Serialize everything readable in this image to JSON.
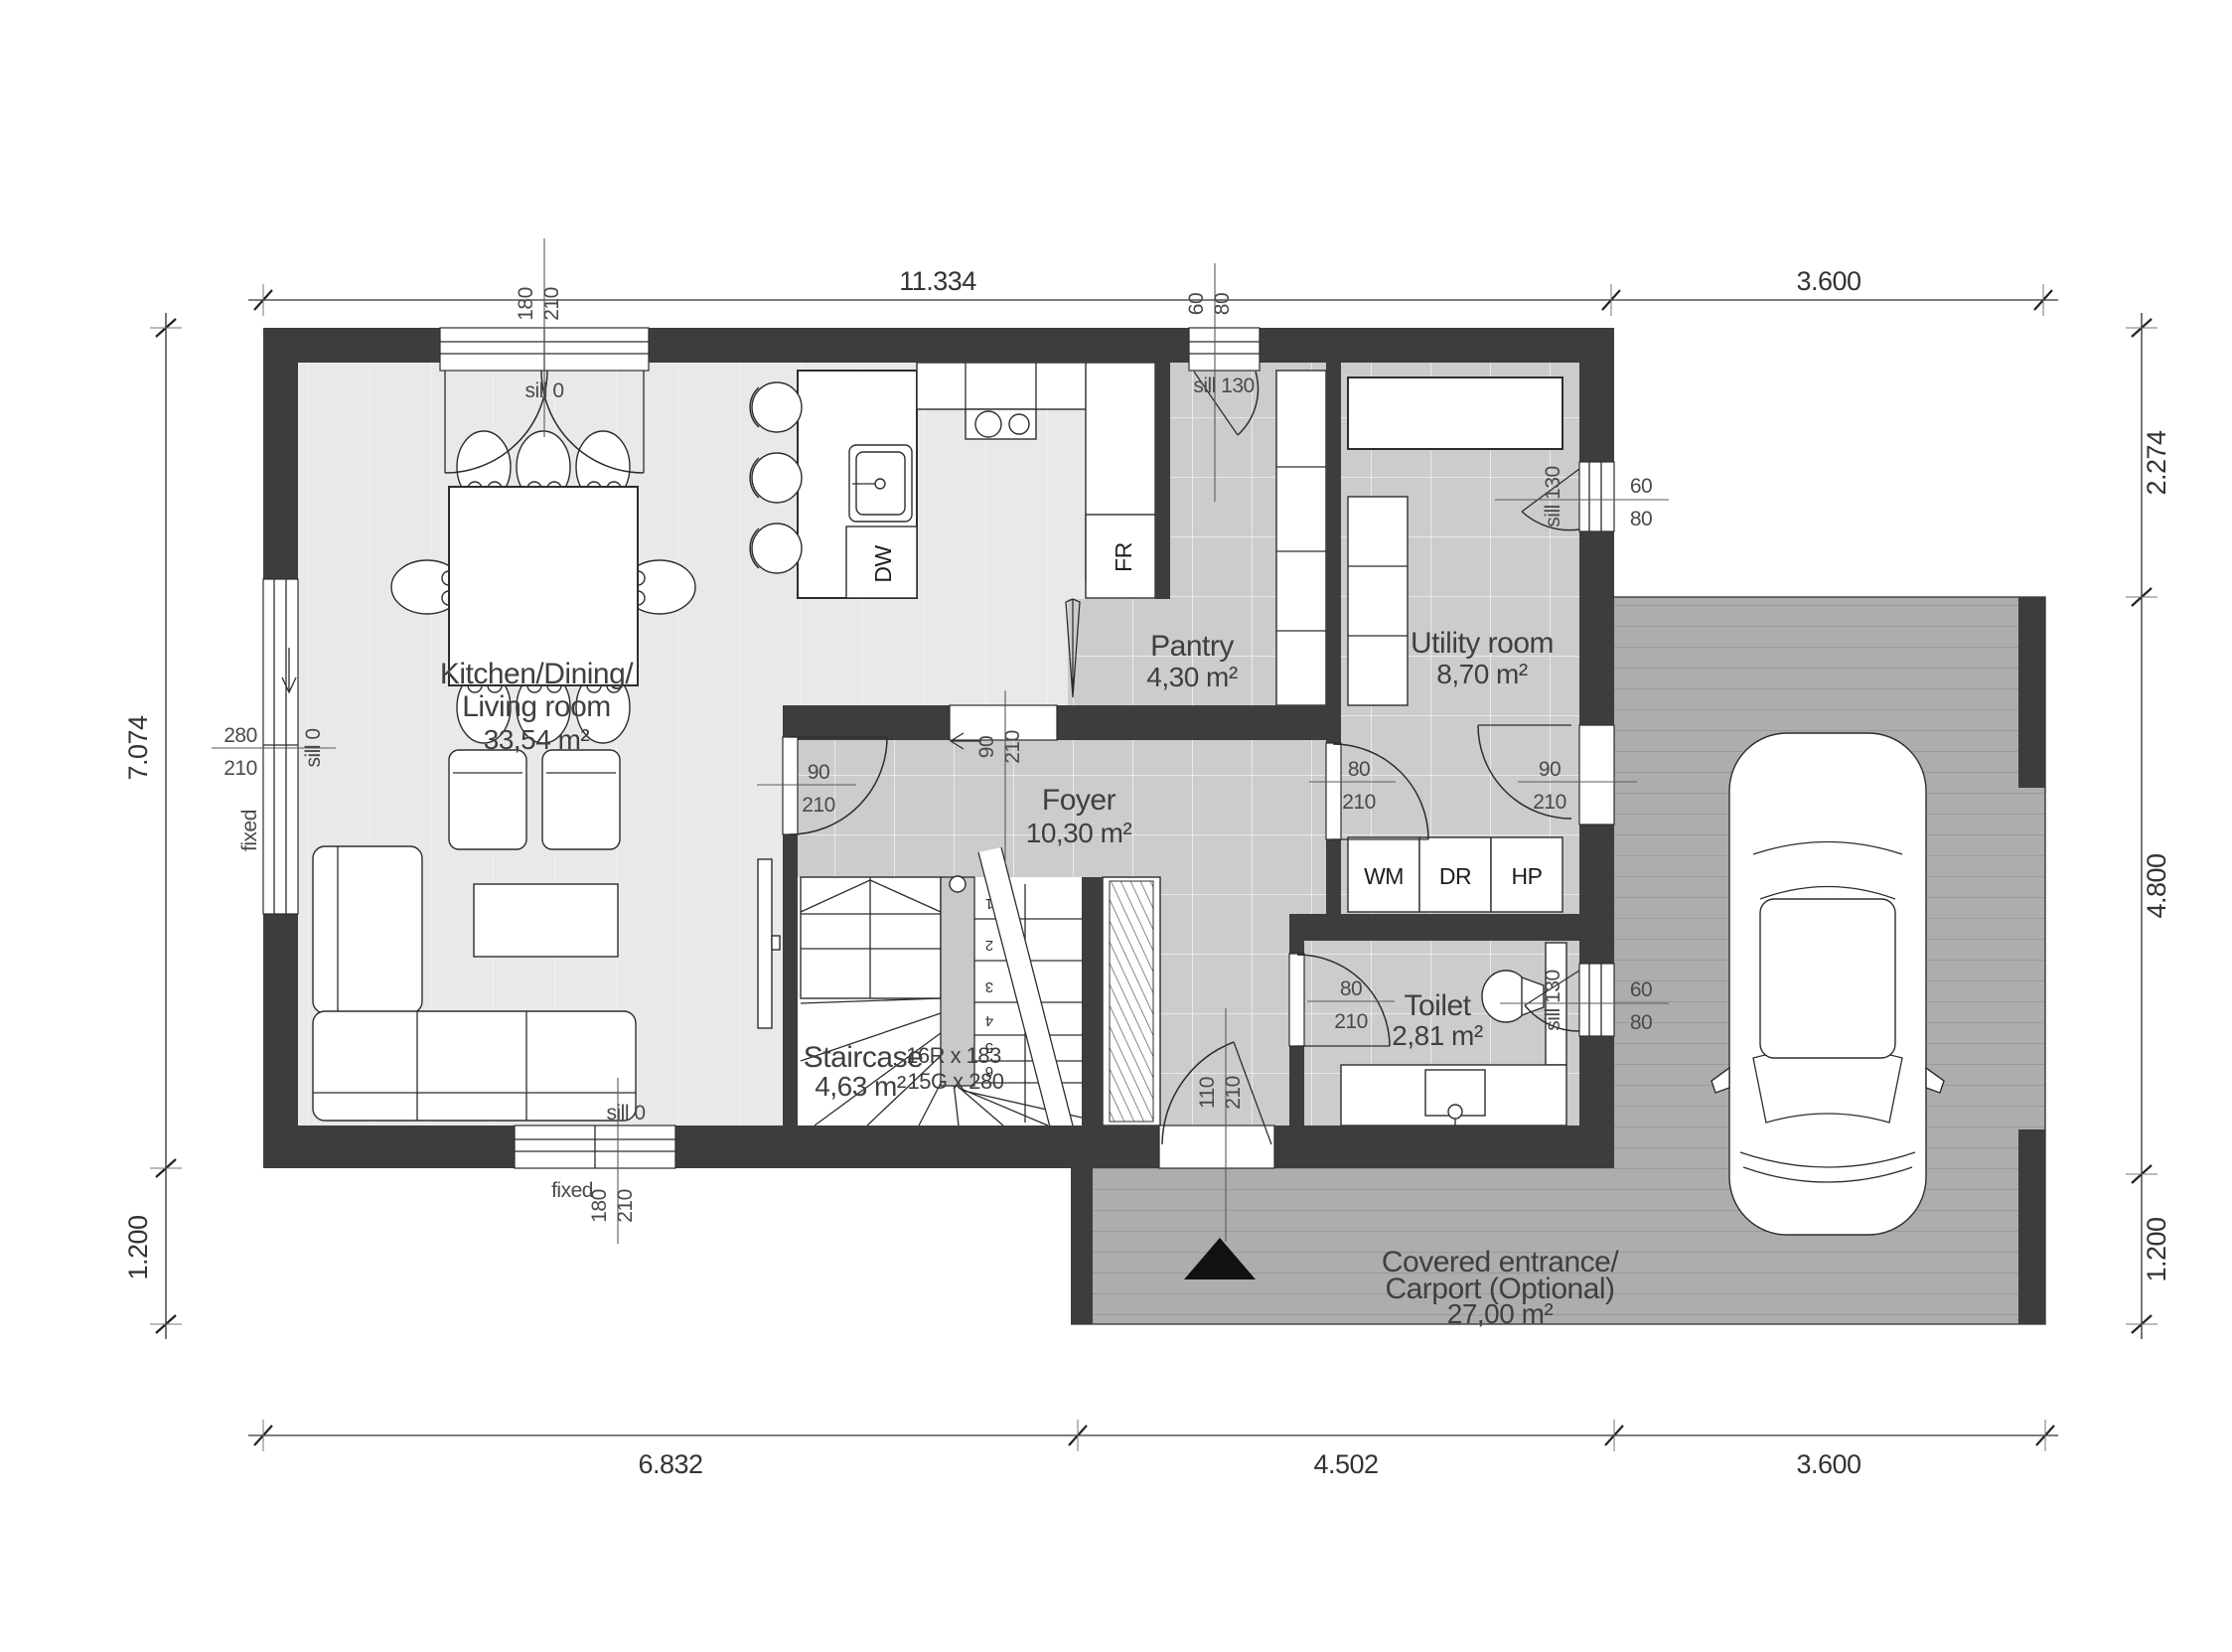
{
  "rooms": {
    "living": {
      "line1": "Kitchen/Dining/",
      "line2": "Living room",
      "area": "33,54 m²"
    },
    "pantry": {
      "name": "Pantry",
      "area": "4,30 m²"
    },
    "utility": {
      "name": "Utility room",
      "area": "8,70 m²"
    },
    "foyer": {
      "name": "Foyer",
      "area": "10,30 m²"
    },
    "staircase": {
      "name": "Staircase",
      "area": "4,63 m²",
      "risers": "16R x 183",
      "goings": "15G x 280"
    },
    "toilet": {
      "name": "Toilet",
      "area": "2,81 m²"
    },
    "carport": {
      "line1": "Covered entrance/",
      "line2": "Carport (Optional)",
      "area": "27,00 m²"
    }
  },
  "appliances": {
    "dw": "DW",
    "fr": "FR",
    "wm": "WM",
    "dr": "DR",
    "hp": "HP"
  },
  "dimensions": {
    "top": [
      "11.334",
      "3.600"
    ],
    "bottom": [
      "6.832",
      "4.502",
      "3.600"
    ],
    "left": [
      "7.074",
      "1.200"
    ],
    "right": [
      "2.274",
      "4.800",
      "1.200"
    ]
  },
  "openings": {
    "patio_door": {
      "w": "180",
      "h": "210",
      "sill": "sill 0"
    },
    "left_window": {
      "w": "280",
      "h": "210",
      "sill": "sill 0",
      "note": "fixed"
    },
    "bottom_window": {
      "w": "180",
      "h": "210",
      "sill": "sill 0",
      "note": "fixed"
    },
    "pantry_window": {
      "w": "60",
      "h": "80",
      "sill": "sill 130"
    },
    "utility_window": {
      "w": "60",
      "h": "80",
      "sill": "sill 130"
    },
    "toilet_window": {
      "w": "60",
      "h": "80",
      "sill": "sill 130"
    },
    "entry_door": {
      "w": "110",
      "h": "210"
    },
    "foyer_door": {
      "w": "90",
      "h": "210"
    },
    "kitchen_pass": {
      "w": "90",
      "h": "210"
    },
    "utility_door": {
      "w": "80",
      "h": "210"
    },
    "utility_ext_door": {
      "w": "90",
      "h": "210"
    },
    "toilet_door": {
      "w": "80",
      "h": "210"
    }
  },
  "stairs": {
    "steps": [
      "1",
      "2",
      "3",
      "4",
      "5",
      "6"
    ]
  },
  "colors": {
    "wall": "#3d3d3d",
    "floor": "#e9e9e9",
    "tile": "#cccccc",
    "deck": "#adadad",
    "landing": "#c9c9c9",
    "line": "#2d2d2d"
  }
}
